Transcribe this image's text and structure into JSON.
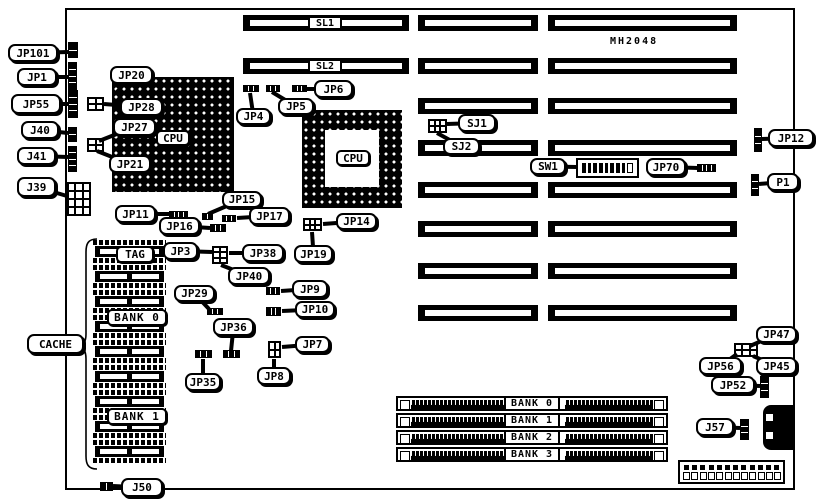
{
  "figure": {
    "type": "motherboard jumper location diagram",
    "part_number": "MH2048"
  },
  "colors": {
    "ink": "#000000",
    "paper": "#ffffff"
  },
  "board": {
    "x": 65,
    "y": 8,
    "w": 730,
    "h": 482
  },
  "slots": {
    "h": 16,
    "barA": {
      "x": 243,
      "w": 166
    },
    "barB": {
      "x": 418,
      "w": 120
    },
    "barC": {
      "x": 548,
      "w": 189
    },
    "rows": [
      {
        "y": 15,
        "label": "SL1"
      },
      {
        "y": 58,
        "label": "SL2"
      },
      {
        "y": 98
      },
      {
        "y": 140
      },
      {
        "y": 182
      },
      {
        "y": 221
      },
      {
        "y": 263
      },
      {
        "y": 305
      }
    ]
  },
  "cpu_sockets": [
    {
      "id": "cpu1",
      "style": "solid",
      "x": 112,
      "y": 77,
      "w": 122,
      "h": 115
    },
    {
      "id": "cpu2",
      "style": "ring",
      "x": 302,
      "y": 110,
      "w": 100,
      "h": 98,
      "inner": {
        "x": 23,
        "y": 20,
        "w": 54,
        "h": 57
      }
    }
  ],
  "cache": {
    "x": 93,
    "w": 73,
    "h": 23,
    "chip_ys": [
      240,
      265,
      290,
      315,
      340,
      365,
      390,
      415,
      440
    ]
  },
  "simm": {
    "x": 396,
    "w": 272,
    "h": 15,
    "ys": [
      396,
      413,
      430,
      447
    ]
  },
  "components": [
    {
      "id": "jp101-conn",
      "type": "vpins",
      "x": 68,
      "y": 42,
      "w": 10,
      "h": 16,
      "cells": 2
    },
    {
      "id": "jp1-conn",
      "type": "vpins",
      "x": 68,
      "y": 62,
      "w": 9,
      "h": 28,
      "cells": 4
    },
    {
      "id": "jp55-conn",
      "type": "vpins",
      "x": 68,
      "y": 90,
      "w": 10,
      "h": 28,
      "cells": 4
    },
    {
      "id": "j40-conn",
      "type": "vpins",
      "x": 68,
      "y": 127,
      "w": 9,
      "h": 15,
      "cells": 2
    },
    {
      "id": "j41-conn",
      "type": "vpins",
      "x": 68,
      "y": 146,
      "w": 9,
      "h": 26,
      "cells": 4
    },
    {
      "id": "j39-conn",
      "type": "block",
      "x": 67,
      "y": 182,
      "w": 24,
      "h": 34,
      "rows": 4,
      "cols": 3
    },
    {
      "id": "jp28-block",
      "type": "block",
      "x": 87,
      "y": 97,
      "w": 17,
      "h": 14,
      "rows": 2,
      "cols": 2
    },
    {
      "id": "jp21-block",
      "type": "block",
      "x": 87,
      "y": 138,
      "w": 17,
      "h": 14,
      "rows": 2,
      "cols": 2
    },
    {
      "id": "jp4-conn",
      "type": "hpins",
      "x": 243,
      "y": 85,
      "w": 16,
      "h": 7,
      "cells": 3
    },
    {
      "id": "jp5-conn",
      "type": "hpins",
      "x": 266,
      "y": 85,
      "w": 14,
      "h": 7,
      "cells": 3
    },
    {
      "id": "jp6-conn",
      "type": "hpins",
      "x": 292,
      "y": 85,
      "w": 15,
      "h": 7,
      "cells": 3
    },
    {
      "id": "sj-block",
      "type": "block",
      "x": 428,
      "y": 119,
      "w": 19,
      "h": 14,
      "rows": 2,
      "cols": 3
    },
    {
      "id": "sw1-switch",
      "type": "dip",
      "x": 576,
      "y": 158,
      "w": 63,
      "h": 20,
      "cells": 9
    },
    {
      "id": "jp70-conn",
      "type": "hpins",
      "x": 697,
      "y": 164,
      "w": 19,
      "h": 8,
      "cells": 4
    },
    {
      "id": "jp12-conn",
      "type": "vpins",
      "x": 754,
      "y": 128,
      "w": 8,
      "h": 24,
      "cells": 3
    },
    {
      "id": "p1-conn",
      "type": "vpins",
      "x": 751,
      "y": 174,
      "w": 8,
      "h": 22,
      "cells": 3
    },
    {
      "id": "jp15-conn",
      "type": "hpins",
      "x": 202,
      "y": 213,
      "w": 11,
      "h": 7,
      "cells": 2
    },
    {
      "id": "jp17-conn",
      "type": "hpins",
      "x": 222,
      "y": 215,
      "w": 14,
      "h": 7,
      "cells": 3
    },
    {
      "id": "jp11-conn",
      "type": "hpins",
      "x": 169,
      "y": 211,
      "w": 19,
      "h": 8,
      "cells": 4
    },
    {
      "id": "jp16-conn",
      "type": "hpins",
      "x": 210,
      "y": 224,
      "w": 16,
      "h": 8,
      "cells": 3
    },
    {
      "id": "jp14-block",
      "type": "block",
      "x": 303,
      "y": 218,
      "w": 19,
      "h": 13,
      "rows": 2,
      "cols": 3
    },
    {
      "id": "jp3-block",
      "type": "block",
      "x": 212,
      "y": 246,
      "w": 16,
      "h": 18,
      "rows": 3,
      "cols": 2
    },
    {
      "id": "jp29-conn",
      "type": "hpins",
      "x": 207,
      "y": 308,
      "w": 16,
      "h": 7,
      "cells": 3
    },
    {
      "id": "jp9-conn",
      "type": "hpins",
      "x": 266,
      "y": 287,
      "w": 14,
      "h": 8,
      "cells": 3
    },
    {
      "id": "jp10-conn",
      "type": "hpins",
      "x": 266,
      "y": 307,
      "w": 15,
      "h": 9,
      "cells": 3
    },
    {
      "id": "jp7-block",
      "type": "block",
      "x": 268,
      "y": 341,
      "w": 13,
      "h": 17,
      "rows": 2,
      "cols": 2
    },
    {
      "id": "jp35-conn",
      "type": "hpins",
      "x": 195,
      "y": 350,
      "w": 17,
      "h": 8,
      "cells": 3
    },
    {
      "id": "jp36-conn",
      "type": "hpins",
      "x": 223,
      "y": 350,
      "w": 17,
      "h": 8,
      "cells": 3
    },
    {
      "id": "jp47-block",
      "type": "block",
      "x": 734,
      "y": 343,
      "w": 24,
      "h": 14,
      "rows": 2,
      "cols": 3
    },
    {
      "id": "jp52-conn",
      "type": "vpins",
      "x": 760,
      "y": 376,
      "w": 9,
      "h": 22,
      "cells": 3
    },
    {
      "id": "j57-conn",
      "type": "vpins",
      "x": 740,
      "y": 419,
      "w": 9,
      "h": 21,
      "cells": 3
    },
    {
      "id": "j50-conn",
      "type": "hpins",
      "x": 100,
      "y": 482,
      "w": 13,
      "h": 9,
      "cells": 2
    },
    {
      "id": "keyboard-connector",
      "type": "kb",
      "x": 763,
      "y": 405,
      "w": 32,
      "h": 45
    },
    {
      "id": "power-connector",
      "type": "power",
      "x": 678,
      "y": 460,
      "w": 107,
      "h": 24,
      "pins": 12
    }
  ],
  "callouts": [
    {
      "id": "jp101",
      "label": "JP101",
      "x": 8,
      "y": 44,
      "w": 50,
      "h": 18,
      "tx": 68,
      "ty": 52
    },
    {
      "id": "jp1",
      "label": "JP1",
      "x": 17,
      "y": 68,
      "w": 40,
      "h": 18,
      "tx": 68,
      "ty": 77
    },
    {
      "id": "jp55",
      "label": "JP55",
      "x": 11,
      "y": 94,
      "w": 50,
      "h": 20,
      "tx": 68,
      "ty": 104
    },
    {
      "id": "j40",
      "label": "J40",
      "x": 21,
      "y": 121,
      "w": 38,
      "h": 18,
      "tx": 68,
      "ty": 133
    },
    {
      "id": "j41",
      "label": "J41",
      "x": 17,
      "y": 147,
      "w": 39,
      "h": 18,
      "tx": 68,
      "ty": 157
    },
    {
      "id": "j39",
      "label": "J39",
      "x": 17,
      "y": 177,
      "w": 39,
      "h": 20,
      "tx": 67,
      "ty": 196
    },
    {
      "id": "jp20",
      "label": "JP20",
      "x": 110,
      "y": 66,
      "w": 43,
      "h": 18,
      "tx": 117,
      "ty": 92
    },
    {
      "id": "jp28",
      "label": "JP28",
      "x": 120,
      "y": 98,
      "w": 43,
      "h": 18,
      "tx": 104,
      "ty": 104
    },
    {
      "id": "jp27",
      "label": "JP27",
      "x": 113,
      "y": 118,
      "w": 43,
      "h": 18,
      "tx": 99,
      "ty": 141
    },
    {
      "id": "jp21",
      "label": "JP21",
      "x": 109,
      "y": 155,
      "w": 42,
      "h": 18,
      "tx": 97,
      "ty": 151
    },
    {
      "id": "jp4",
      "label": "JP4",
      "x": 236,
      "y": 108,
      "w": 35,
      "h": 17,
      "tx": 250,
      "ty": 93
    },
    {
      "id": "jp5",
      "label": "JP5",
      "x": 278,
      "y": 98,
      "w": 36,
      "h": 17,
      "tx": 272,
      "ty": 92
    },
    {
      "id": "jp6",
      "label": "JP6",
      "x": 314,
      "y": 80,
      "w": 39,
      "h": 18,
      "tx": 307,
      "ty": 89
    },
    {
      "id": "sj1",
      "label": "SJ1",
      "x": 458,
      "y": 114,
      "w": 38,
      "h": 18,
      "tx": 447,
      "ty": 124
    },
    {
      "id": "sj2",
      "label": "SJ2",
      "x": 443,
      "y": 138,
      "w": 37,
      "h": 17,
      "tx": 437,
      "ty": 133
    },
    {
      "id": "sw1",
      "label": "SW1",
      "x": 530,
      "y": 158,
      "w": 36,
      "h": 17,
      "tx": 577,
      "ty": 167
    },
    {
      "id": "jp70",
      "label": "JP70",
      "x": 646,
      "y": 158,
      "w": 40,
      "h": 18,
      "tx": 698,
      "ty": 168
    },
    {
      "id": "jp12",
      "label": "JP12",
      "x": 768,
      "y": 129,
      "w": 46,
      "h": 18,
      "tx": 762,
      "ty": 139
    },
    {
      "id": "p1",
      "label": "P1",
      "x": 767,
      "y": 173,
      "w": 32,
      "h": 18,
      "tx": 759,
      "ty": 184
    },
    {
      "id": "jp15",
      "label": "JP15",
      "x": 222,
      "y": 191,
      "w": 40,
      "h": 17,
      "tx": 208,
      "ty": 214
    },
    {
      "id": "jp17",
      "label": "JP17",
      "x": 249,
      "y": 207,
      "w": 41,
      "h": 18,
      "tx": 237,
      "ty": 218
    },
    {
      "id": "jp11",
      "label": "JP11",
      "x": 115,
      "y": 205,
      "w": 41,
      "h": 18,
      "tx": 170,
      "ty": 214
    },
    {
      "id": "jp16",
      "label": "JP16",
      "x": 159,
      "y": 217,
      "w": 41,
      "h": 18,
      "tx": 210,
      "ty": 228
    },
    {
      "id": "jp14",
      "label": "JP14",
      "x": 336,
      "y": 213,
      "w": 41,
      "h": 17,
      "tx": 323,
      "ty": 224
    },
    {
      "id": "jp19",
      "label": "JP19",
      "x": 294,
      "y": 245,
      "w": 39,
      "h": 18,
      "tx": 312,
      "ty": 232
    },
    {
      "id": "jp3",
      "label": "JP3",
      "x": 163,
      "y": 242,
      "w": 35,
      "h": 18,
      "tx": 212,
      "ty": 252
    },
    {
      "id": "jp38",
      "label": "JP38",
      "x": 242,
      "y": 244,
      "w": 42,
      "h": 18,
      "tx": 229,
      "ty": 253
    },
    {
      "id": "jp40",
      "label": "JP40",
      "x": 228,
      "y": 267,
      "w": 42,
      "h": 18,
      "tx": 221,
      "ty": 265
    },
    {
      "id": "jp29",
      "label": "JP29",
      "x": 174,
      "y": 285,
      "w": 41,
      "h": 17,
      "tx": 209,
      "ty": 309
    },
    {
      "id": "jp9",
      "label": "JP9",
      "x": 292,
      "y": 280,
      "w": 36,
      "h": 18,
      "tx": 281,
      "ty": 291
    },
    {
      "id": "jp10",
      "label": "JP10",
      "x": 295,
      "y": 301,
      "w": 40,
      "h": 17,
      "tx": 282,
      "ty": 311
    },
    {
      "id": "jp36",
      "label": "JP36",
      "x": 213,
      "y": 318,
      "w": 41,
      "h": 18,
      "tx": 231,
      "ty": 351
    },
    {
      "id": "jp7",
      "label": "JP7",
      "x": 295,
      "y": 336,
      "w": 35,
      "h": 17,
      "tx": 282,
      "ty": 347
    },
    {
      "id": "jp8",
      "label": "JP8",
      "x": 257,
      "y": 367,
      "w": 34,
      "h": 18,
      "tx": 274,
      "ty": 359
    },
    {
      "id": "jp35",
      "label": "JP35",
      "x": 185,
      "y": 373,
      "w": 36,
      "h": 18,
      "tx": 203,
      "ty": 359
    },
    {
      "id": "cache",
      "label": "CACHE",
      "x": 27,
      "y": 334,
      "w": 57,
      "h": 20,
      "tx": 84,
      "ty": 346
    },
    {
      "id": "jp47",
      "label": "JP47",
      "x": 756,
      "y": 326,
      "w": 41,
      "h": 17,
      "tx": 750,
      "ty": 346
    },
    {
      "id": "jp56",
      "label": "JP56",
      "x": 699,
      "y": 357,
      "w": 43,
      "h": 18,
      "tx": 737,
      "ty": 354
    },
    {
      "id": "jp45",
      "label": "JP45",
      "x": 756,
      "y": 357,
      "w": 41,
      "h": 18,
      "tx": 753,
      "ty": 356
    },
    {
      "id": "jp52",
      "label": "JP52",
      "x": 711,
      "y": 376,
      "w": 44,
      "h": 18,
      "tx": 760,
      "ty": 386
    },
    {
      "id": "j57",
      "label": "J57",
      "x": 696,
      "y": 418,
      "w": 38,
      "h": 18,
      "tx": 740,
      "ty": 428
    },
    {
      "id": "j50",
      "label": "J50",
      "x": 121,
      "y": 478,
      "w": 42,
      "h": 19,
      "tx": 113,
      "ty": 486
    }
  ],
  "overlay_labels": [
    {
      "id": "sl1-label",
      "label": "SL1",
      "x": 308,
      "y": 16,
      "w": 34,
      "h": 14,
      "style": "box"
    },
    {
      "id": "sl2-label",
      "label": "SL2",
      "x": 308,
      "y": 59,
      "w": 34,
      "h": 14,
      "style": "box"
    },
    {
      "id": "part-number",
      "label": "MH2048",
      "x": 610,
      "y": 34,
      "w": 70,
      "h": 14,
      "style": "plain"
    },
    {
      "id": "cpu1-label",
      "label": "CPU",
      "x": 156,
      "y": 130,
      "w": 34,
      "h": 16,
      "style": "round"
    },
    {
      "id": "cpu2-label",
      "label": "CPU",
      "x": 336,
      "y": 150,
      "w": 34,
      "h": 16,
      "style": "round"
    },
    {
      "id": "tag-label",
      "label": "TAG",
      "x": 116,
      "y": 246,
      "w": 38,
      "h": 17,
      "style": "round"
    },
    {
      "id": "cache-bank0",
      "label": "BANK 0",
      "x": 107,
      "y": 309,
      "w": 60,
      "h": 17,
      "style": "round wide"
    },
    {
      "id": "cache-bank1",
      "label": "BANK 1",
      "x": 107,
      "y": 408,
      "w": 60,
      "h": 17,
      "style": "round wide"
    },
    {
      "id": "simm-bank0",
      "label": "BANK 0",
      "x": 504,
      "y": 396,
      "w": 56,
      "h": 15,
      "style": "box wide"
    },
    {
      "id": "simm-bank1",
      "label": "BANK 1",
      "x": 504,
      "y": 413,
      "w": 56,
      "h": 15,
      "style": "box wide"
    },
    {
      "id": "simm-bank2",
      "label": "BANK 2",
      "x": 504,
      "y": 430,
      "w": 56,
      "h": 15,
      "style": "box wide"
    },
    {
      "id": "simm-bank3",
      "label": "BANK 3",
      "x": 504,
      "y": 447,
      "w": 56,
      "h": 15,
      "style": "box wide"
    }
  ]
}
